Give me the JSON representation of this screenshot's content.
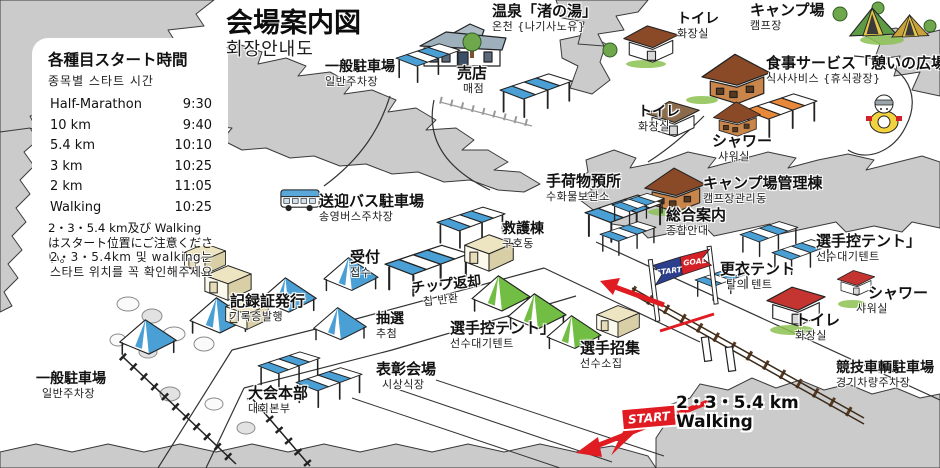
{
  "title": {
    "jp": "会場案内図",
    "kr": "회장안내도"
  },
  "schedule": {
    "heading_jp": "各種目スタート時間",
    "heading_kr": "종목별 스타트 시간",
    "rows": [
      {
        "event": "Half-Marathon",
        "time": "9:30"
      },
      {
        "event": "10 km",
        "time": "9:40"
      },
      {
        "event": "5.4 km",
        "time": "10:10"
      },
      {
        "event": "3 km",
        "time": "10:25"
      },
      {
        "event": "2 km",
        "time": "11:05"
      },
      {
        "event": "Walking",
        "time": "10:25"
      }
    ],
    "note_jp": "2・3・5.4 km及び Walking はスタート位置にご注意ください。",
    "note_kr": "2・3・5.4km 및 walking는 스타트 위치를 꼭 확인해주세요"
  },
  "labels": {
    "parking_top": {
      "jp": "一般駐車場",
      "kr": "일반주차장"
    },
    "baiten": {
      "jp": "売店",
      "kr": "매점"
    },
    "onsen": {
      "jp": "温泉「渚の湯」",
      "kr": "온천 {나기사노유}"
    },
    "toilet_top": {
      "jp": "トイレ",
      "kr": "화장실"
    },
    "campsite": {
      "jp": "キャンプ場",
      "kr": "캠프장"
    },
    "food_service": {
      "jp": "食事サービス「憩いの広場」",
      "kr": "식사사비스 {휴식광장}"
    },
    "toilet_mid": {
      "jp": "トイレ",
      "kr": "화장실"
    },
    "shower_mid": {
      "jp": "シャワー",
      "kr": "샤워실"
    },
    "baggage": {
      "jp": "手荷物預所",
      "kr": "수화물보관소"
    },
    "camp_admin": {
      "jp": "キャンプ場管理棟",
      "kr": "캠프장관리동"
    },
    "info": {
      "jp": "総合案内",
      "kr": "종합안내"
    },
    "first_aid": {
      "jp": "救護棟",
      "kr": "구호동"
    },
    "shuttle_parking": {
      "jp": "送迎バス駐車場",
      "kr": "송영버스주차장"
    },
    "reception": {
      "jp": "受付",
      "kr": "접수"
    },
    "chip_return": {
      "jp": "チップ返却",
      "kr": "칩 반환"
    },
    "record_cert": {
      "jp": "記録証発行",
      "kr": "기록증발행"
    },
    "lottery": {
      "jp": "抽選",
      "kr": "추첨"
    },
    "athlete_tent_center": {
      "jp": "選手控テント」",
      "kr": "선수대기텐트"
    },
    "athlete_muster": {
      "jp": "選手招集",
      "kr": "선수소집"
    },
    "awards": {
      "jp": "表彰会場",
      "kr": "시상식장"
    },
    "hq": {
      "jp": "大会本部",
      "kr": "대회본부"
    },
    "parking_bottom": {
      "jp": "一般駐車場",
      "kr": "일반주차장"
    },
    "changing_tent": {
      "jp": "更衣テント",
      "kr": "탈의 텐트"
    },
    "athlete_tent_right": {
      "jp": "選手控テント」",
      "kr": "선수대기텐트"
    },
    "shower_right": {
      "jp": "シャワー",
      "kr": "샤워실"
    },
    "toilet_bottom": {
      "jp": "トイレ",
      "kr": "화장실"
    },
    "vehicle_parking": {
      "jp": "競技車輌駐車場",
      "kr": "경기차량주차장"
    }
  },
  "route": {
    "banner_start": "START",
    "banner_goal": "GOAL",
    "start_flag": "START",
    "course_line1": "2・3・5.4 km",
    "course_line2": "Walking"
  },
  "colors": {
    "tent_blue": "#4A9FD4",
    "tent_green": "#72BE44",
    "tent_orange": "#E8883A",
    "route_red": "#E01B22",
    "banner_blue": "#2B3F8C",
    "banner_red": "#D42027",
    "forest_gray": "#CBCBCB"
  }
}
